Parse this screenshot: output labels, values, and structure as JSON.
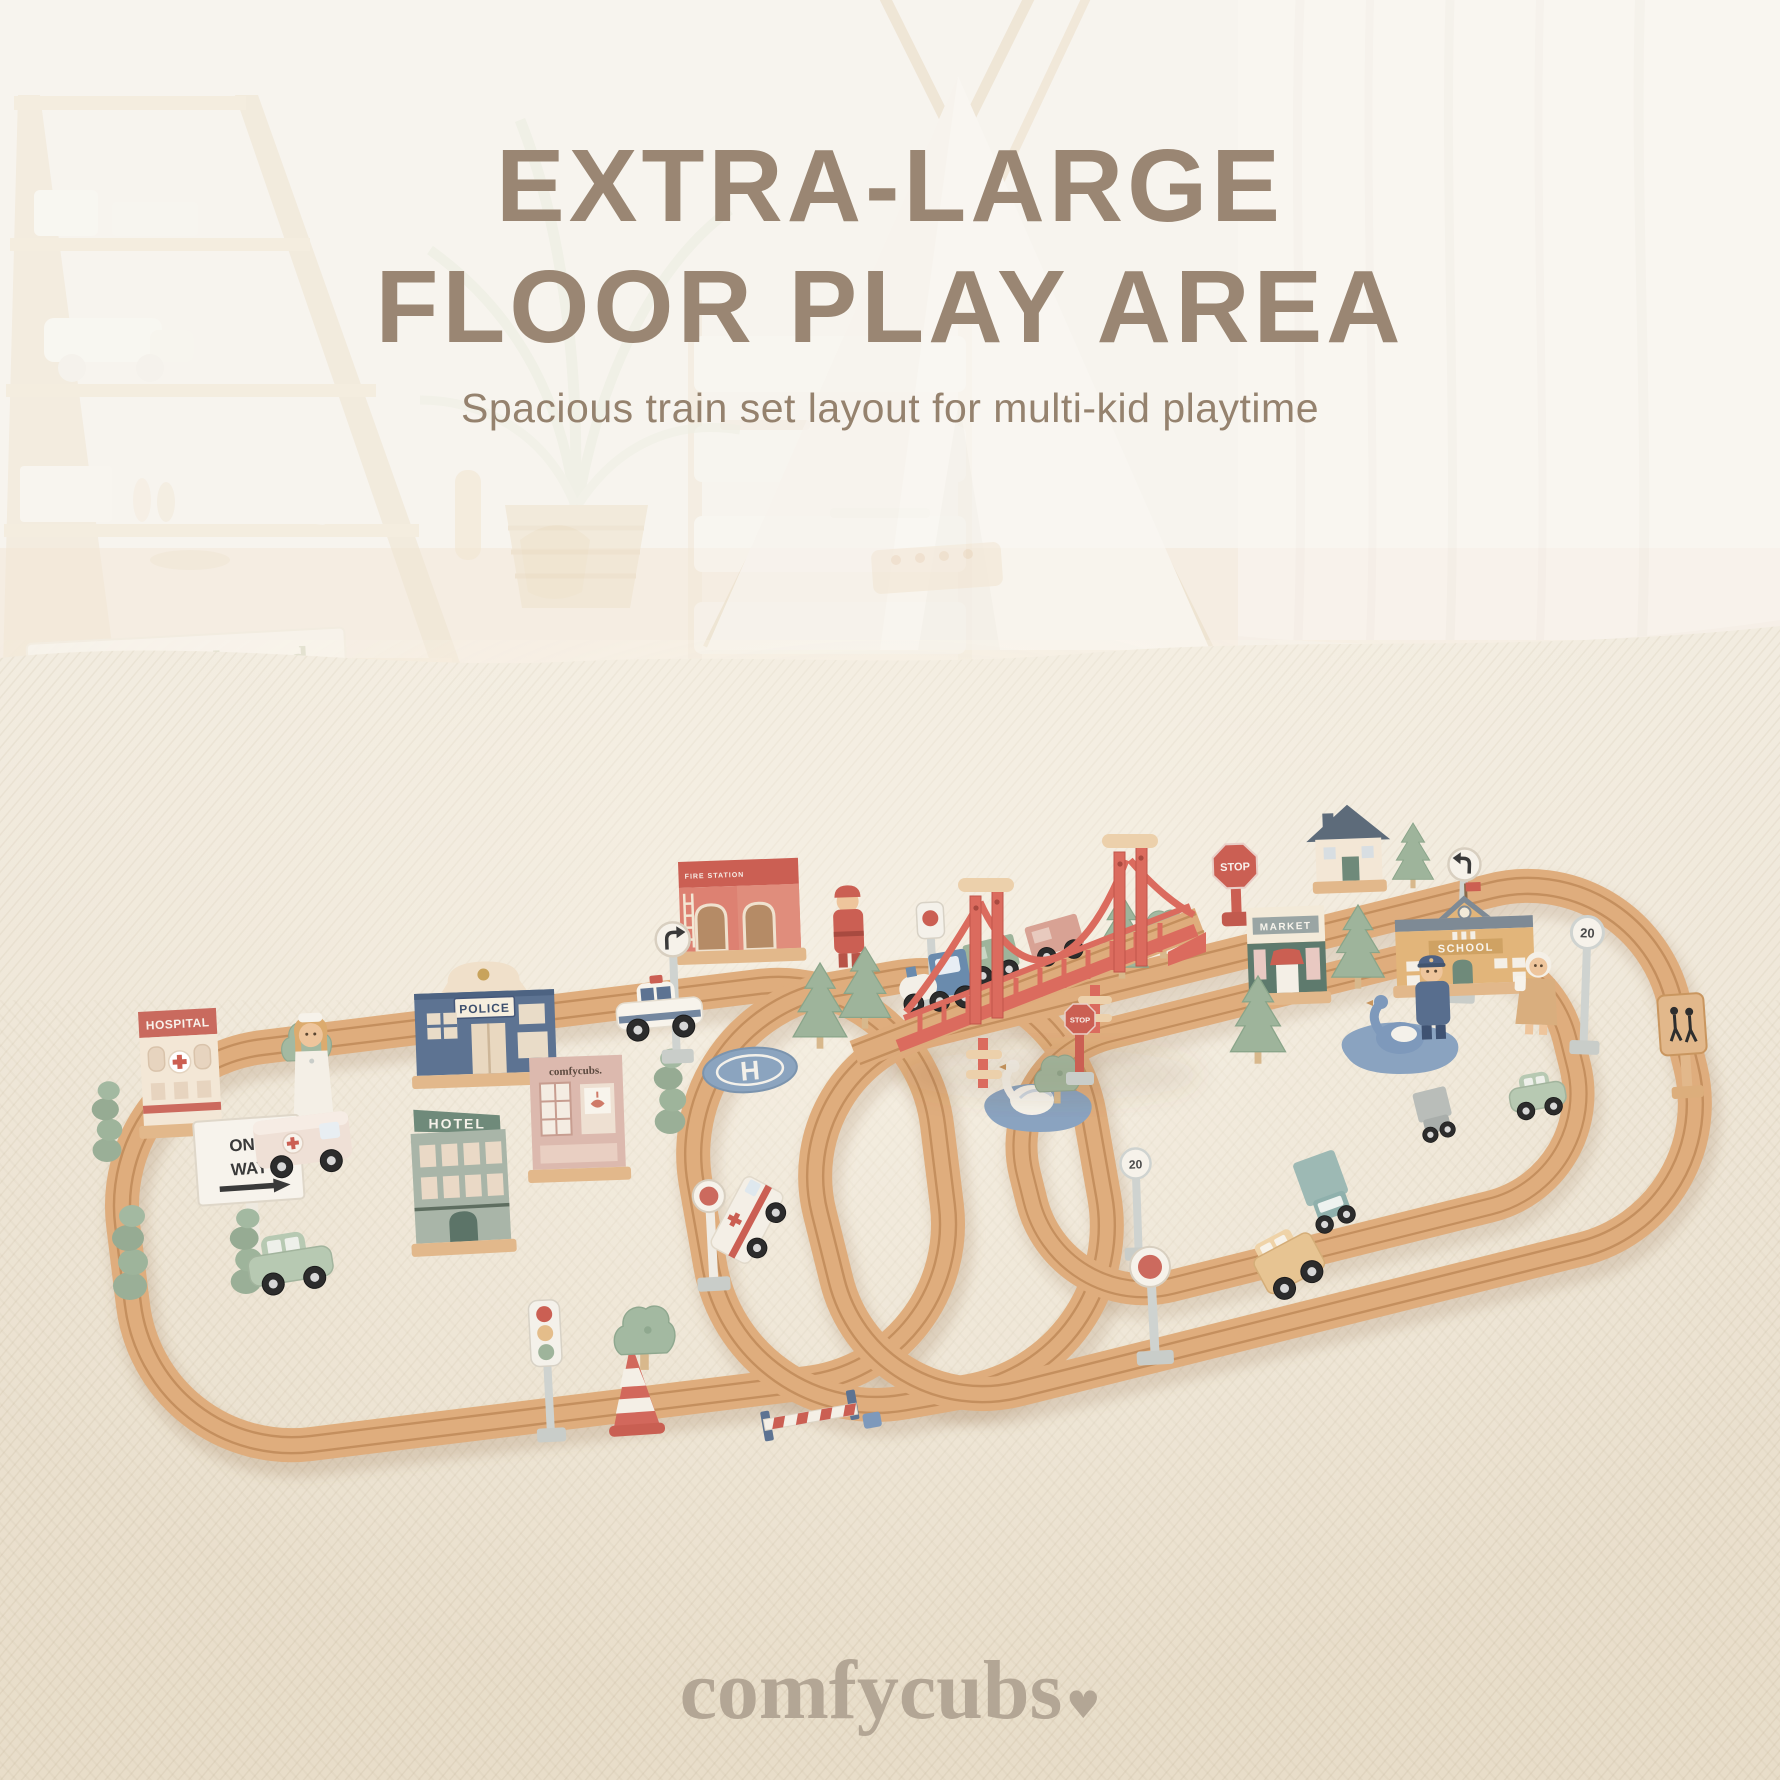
{
  "header": {
    "title_line1": "EXTRA-LARGE",
    "title_line2": "FLOOR PLAY AREA",
    "subtitle": "Spacious train set layout for multi-kid playtime",
    "title_color": "#9a8673",
    "subtitle_color": "#95826e"
  },
  "brand": {
    "name": "comfycubs",
    "heart": "♥",
    "color": "#b3a695"
  },
  "room": {
    "book_title": "little seed"
  },
  "playset": {
    "buildings": {
      "hospital": "HOSPITAL",
      "police": "POLICE",
      "hotel": "HOTEL",
      "shop": "comfycubs.",
      "fire_station": "FIRE STATION",
      "market": "MARKET",
      "school": "SCHOOL"
    },
    "signs": {
      "one_way_line1": "ONE",
      "one_way_line2": "WAY",
      "stop": "STOP",
      "stop_small": "STOP",
      "speed_limit_right": "20",
      "speed_limit_bottom": "20",
      "helipad_letter": "H"
    },
    "colors": {
      "track_wood": "#dfad7d",
      "bridge_red": "#db6b5e",
      "sage_green": "#9eb49b",
      "steel_blue": "#6a8bad",
      "pond_blue": "#8aa3c0",
      "carpet": "#ece3d3"
    }
  }
}
